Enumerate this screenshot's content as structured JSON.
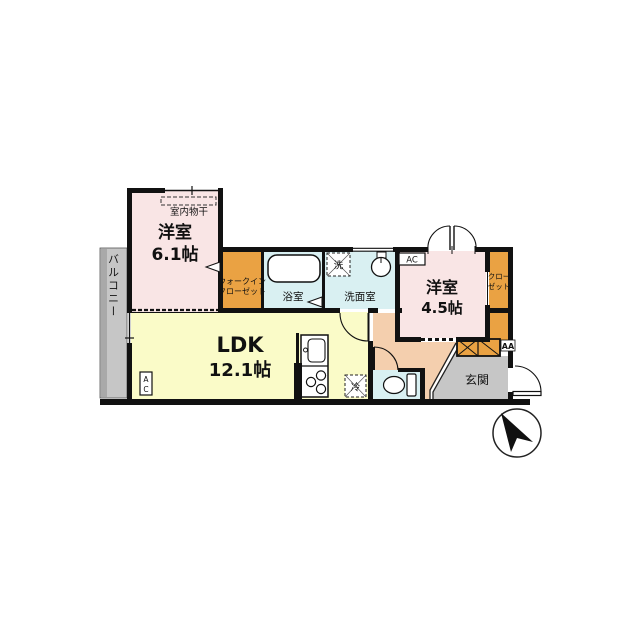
{
  "plan": {
    "rooms": {
      "bedroom1_name": "洋室",
      "bedroom1_size": "6.1帖",
      "ldk_name": "LDK",
      "ldk_size": "12.1帖",
      "bedroom2_name": "洋室",
      "bedroom2_size": "4.5帖",
      "balcony": "バルコニー",
      "wic_line1": "ウォークイン",
      "wic_line2": "クローゼット",
      "bath": "浴室",
      "washroom": "洗面室",
      "closet_line1": "クロー",
      "closet_line2": "ゼット",
      "entrance": "玄関",
      "indoor_drying": "室内物干"
    },
    "fixtures": {
      "washer": "洗",
      "fridge": "冷",
      "ac_bedroom2": "AC",
      "ac_ldk_a": "A",
      "ac_ldk_c": "C",
      "aa_label": "AA"
    },
    "colors": {
      "bedroom_pink": "#f9e5e5",
      "ldk_yellow": "#fafbc8",
      "closet_orange": "#eaa243",
      "wet_area_cyan": "#d9f0f2",
      "hall_salmon": "#f4cfae",
      "entrance_gray": "#c6c6c6",
      "wall_black": "#111111"
    }
  }
}
